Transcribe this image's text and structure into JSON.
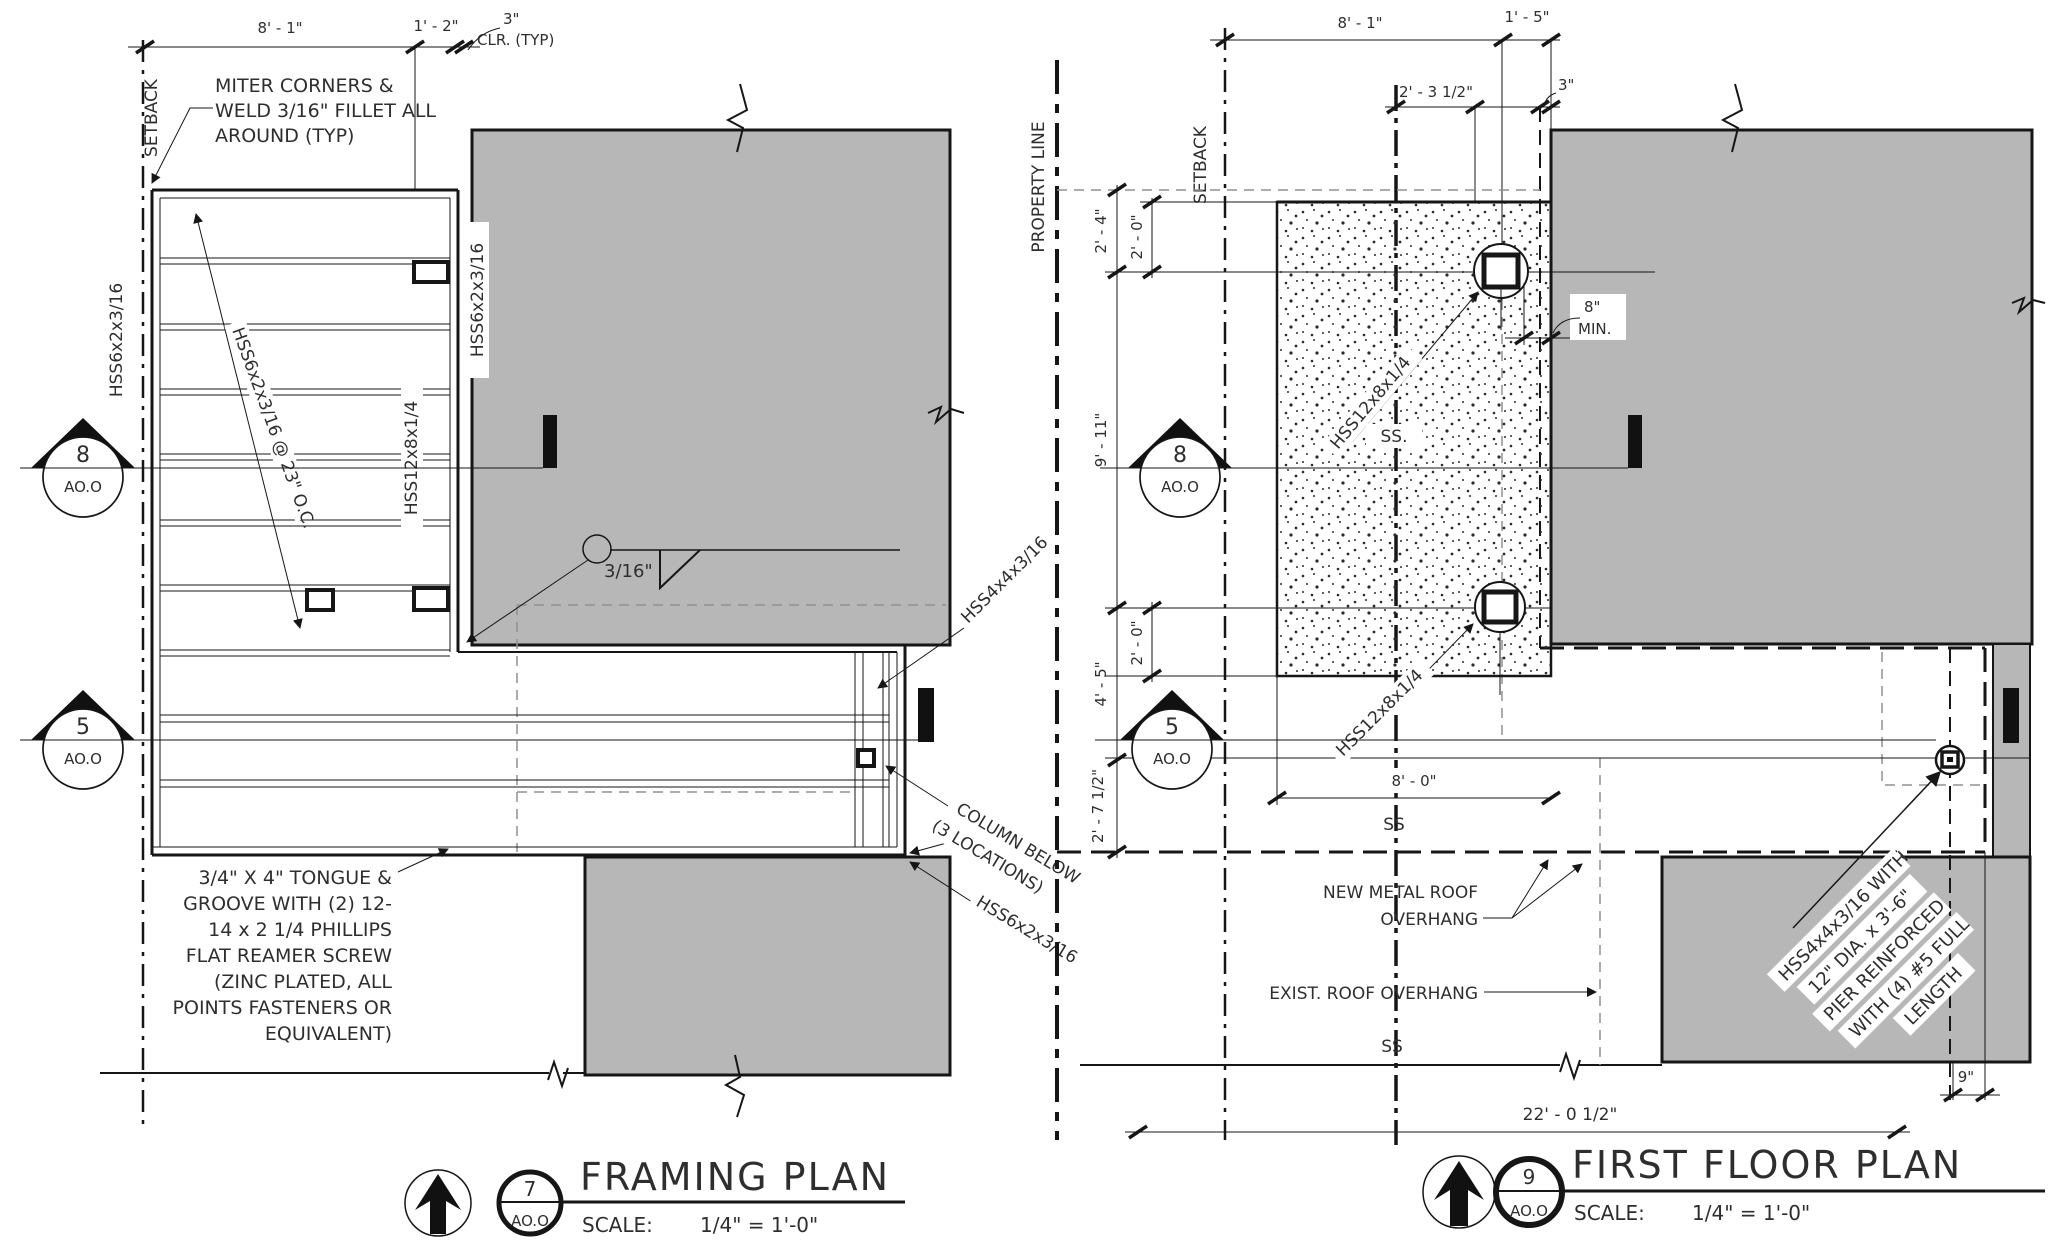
{
  "palette": {
    "background": "#ffffff",
    "line": "#161616",
    "building_gray": "#b7b7b7",
    "hidden_dash_gray": "#909090"
  },
  "framing_plan": {
    "name": "FRAMING PLAN",
    "detail_ref": {
      "number": "7",
      "sheet": "AO.O"
    },
    "scale": {
      "label": "SCALE:",
      "value": "1/4\" = 1'-0\""
    },
    "section_markers": [
      {
        "number": "8",
        "sheet": "AO.O"
      },
      {
        "number": "5",
        "sheet": "AO.O"
      }
    ],
    "setback_label": "SETBACK",
    "dimensions": {
      "top_width": "8' - 1\"",
      "top_offset": "1' - 2\"",
      "clearance": "3\"",
      "clearance_note": "CLR. (TYP)"
    },
    "weld_note": {
      "size": "3/16\""
    },
    "member_labels": {
      "edge_beam_vertical": "HSS6x2x3/16",
      "joist_callout": "HSS6x2x3/16 @ 23\" O.C.",
      "girder_vertical": "HSS12x8x1/4",
      "face_beam_vertical": "HSS6x2x3/16",
      "corner_post_diagonal": "HSS4x4x3/16",
      "lower_edge_diagonal": "HSS6x2x3/16"
    },
    "column_note": {
      "line1": "COLUMN BELOW",
      "line2": "(3 LOCATIONS)"
    },
    "miter_note": {
      "line1": "MITER CORNERS &",
      "line2": "WELD 3/16\" FILLET ALL",
      "line3": "AROUND (TYP)"
    },
    "deck_note": {
      "line1": "3/4\" X 4\" TONGUE &",
      "line2": "GROOVE WITH (2) 12-",
      "line3": "14 x 2 1/4 PHILLIPS",
      "line4": "FLAT REAMER SCREW",
      "line5": "(ZINC PLATED, ALL",
      "line6": "POINTS FASTENERS OR",
      "line7": "EQUIVALENT)"
    }
  },
  "first_floor_plan": {
    "name": "FIRST FLOOR PLAN",
    "detail_ref": {
      "number": "9",
      "sheet": "AO.O"
    },
    "scale": {
      "label": "SCALE:",
      "value": "1/4\" = 1'-0\""
    },
    "section_markers": [
      {
        "number": "8",
        "sheet": "AO.O"
      },
      {
        "number": "5",
        "sheet": "AO.O"
      }
    ],
    "property_line_label": "PROPERTY LINE",
    "setback_label": "SETBACK",
    "dimensions": {
      "top_width": "8' - 1\"",
      "top_offset": "1' - 5\"",
      "top_clearance": "3\"",
      "column_offset": "2' - 3 1/2\"",
      "left_upper_a": "2' - 4\"",
      "left_upper_b": "2' - 0\"",
      "left_span": "9' - 11\"",
      "left_mid": "2' - 0\"",
      "left_lower_a": "4' - 5\"",
      "left_lower_b": "2' - 7 1/2\"",
      "slab_width": "8' - 0\"",
      "bearing": "8\"",
      "bearing_note": "MIN.",
      "overall_width": "22' - 0 1/2\"",
      "corner_offset": "9\""
    },
    "ss_labels": {
      "upper": "SS.",
      "middle": "SS",
      "lower": "SS"
    },
    "member_labels": {
      "beam_upper": "HSS12x8x1/4",
      "beam_lower": "HSS12x8x1/4"
    },
    "roof_notes": {
      "new_line1": "NEW METAL ROOF",
      "new_line2": "OVERHANG",
      "existing": "EXIST. ROOF OVERHANG"
    },
    "pier_note": {
      "line1": "HSS4x4x3/16 WITH",
      "line2": "12\" DIA. x 3'-6\"",
      "line3": "PIER REINFORCED",
      "line4": "WITH (4) #5 FULL",
      "line5": "LENGTH"
    }
  }
}
